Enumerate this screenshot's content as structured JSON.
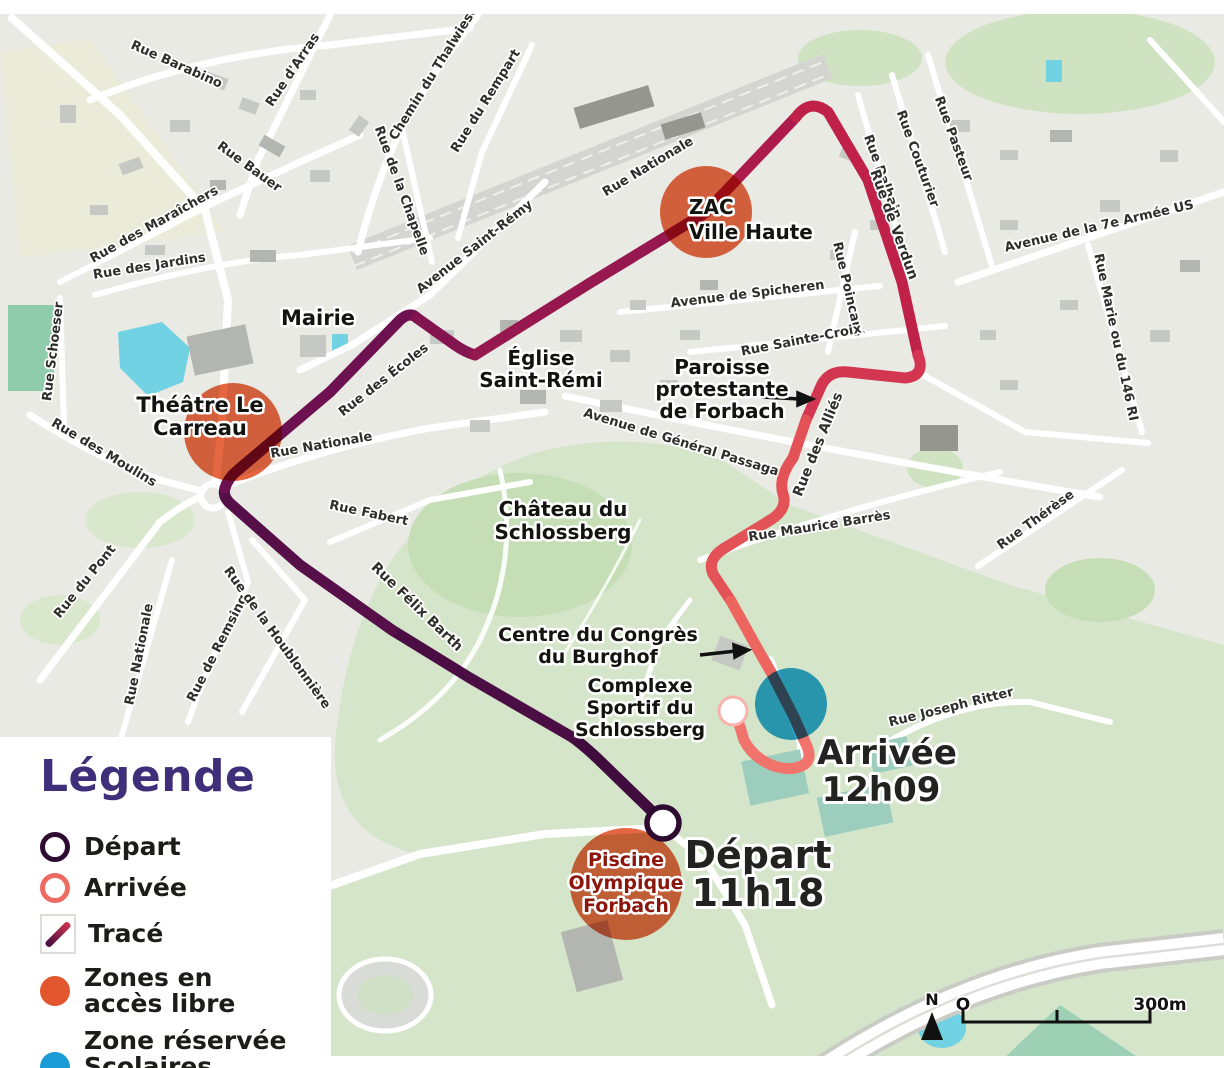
{
  "legend": {
    "title": "Légende",
    "items": [
      {
        "id": "depart",
        "lines": [
          "Départ"
        ]
      },
      {
        "id": "arrivee",
        "lines": [
          "Arrivée"
        ]
      },
      {
        "id": "trace",
        "lines": [
          "Tracé"
        ]
      },
      {
        "id": "zones-acces-libre",
        "lines": [
          "Zones en",
          "accès libre"
        ]
      },
      {
        "id": "zone-reservee",
        "lines": [
          "Zone réservée",
          "Scolaires uniquement"
        ]
      }
    ]
  },
  "colors": {
    "legend_title": "#3f2f7a",
    "depart_ring": "#2e0c31",
    "arrivee_ring": "#ee6a63",
    "zone_acces_libre": "#e2572d",
    "zone_reservee": "#1b9cd6",
    "route_gradient": [
      "#400c3e",
      "#4b0e44",
      "#570f4a",
      "#6d1150",
      "#83144f",
      "#97174f",
      "#ad1b4c",
      "#c02148",
      "#d33650",
      "#e35257",
      "#ec655e",
      "#f0746b"
    ],
    "water": "#70d2e2",
    "park": "#d5e5ca"
  },
  "map": {
    "scale": {
      "north": "N",
      "zero": "O",
      "bar": "300m"
    },
    "markers": {
      "depart": {
        "name": "Départ",
        "time": "11h18"
      },
      "arrivee": {
        "name": "Arrivée",
        "time": "12h09"
      }
    },
    "zones": [
      {
        "name": "Théâtre Le Carreau",
        "type": "acces-libre"
      },
      {
        "name": "ZAC Ville Haute",
        "type": "acces-libre"
      },
      {
        "name": "Piscine Olympique Forbach",
        "type": "acces-libre"
      },
      {
        "name": "Zone scolaires (arrivée)",
        "type": "reservee"
      }
    ],
    "labels": [
      {
        "lines": [
          "Rue Barabino"
        ],
        "x": 175,
        "y": 68,
        "rot": 24
      },
      {
        "lines": [
          "Rue d'Arras"
        ],
        "x": 296,
        "y": 72,
        "rot": -56
      },
      {
        "lines": [
          "Rue Bauer"
        ],
        "x": 247,
        "y": 170,
        "rot": 36
      },
      {
        "lines": [
          "Rue des Maraîchers"
        ],
        "x": 156,
        "y": 228,
        "rot": -29
      },
      {
        "lines": [
          "Rue des Jardins"
        ],
        "x": 150,
        "y": 270,
        "rot": -9
      },
      {
        "lines": [
          "Chemin du Thalwiese"
        ],
        "x": 437,
        "y": 75,
        "rot": -58
      },
      {
        "lines": [
          "Rue du Rempart"
        ],
        "x": 489,
        "y": 103,
        "rot": -58
      },
      {
        "lines": [
          "Rue de la Chapelle"
        ],
        "x": 398,
        "y": 192,
        "rot": 70
      },
      {
        "lines": [
          "Avenue Saint-Rémy"
        ],
        "x": 477,
        "y": 250,
        "rot": -38
      },
      {
        "lines": [
          "Rue Nationale"
        ],
        "x": 650,
        "y": 170,
        "rot": -31
      },
      {
        "lines": [
          "Rue Poincaré"
        ],
        "x": 844,
        "y": 290,
        "rot": 77
      },
      {
        "lines": [
          "Rue Dalhain"
        ],
        "x": 879,
        "y": 178,
        "rot": 70
      },
      {
        "lines": [
          "Rue Couturier"
        ],
        "x": 914,
        "y": 160,
        "rot": 70
      },
      {
        "lines": [
          "Rue Pasteur"
        ],
        "x": 950,
        "y": 140,
        "rot": 70
      },
      {
        "lines": [
          "Rue de Verdun"
        ],
        "x": 890,
        "y": 226,
        "rot": 70,
        "s": 14,
        "w": 800
      },
      {
        "lines": [
          "Avenue de la 7e Armée US"
        ],
        "x": 1100,
        "y": 230,
        "rot": -13
      },
      {
        "lines": [
          "Rue Marie ou du 146 RI"
        ],
        "x": 1112,
        "y": 338,
        "rot": 78
      },
      {
        "lines": [
          "Avenue de Spicheren"
        ],
        "x": 748,
        "y": 298,
        "rot": -7
      },
      {
        "lines": [
          "Rue Sainte-Croix"
        ],
        "x": 802,
        "y": 344,
        "rot": -11
      },
      {
        "lines": [
          "Avenue de Général Passaga"
        ],
        "x": 680,
        "y": 446,
        "rot": 17
      },
      {
        "lines": [
          "Rue des Alliés"
        ],
        "x": 822,
        "y": 446,
        "rot": -68,
        "s": 14,
        "w": 800
      },
      {
        "lines": [
          "Rue Maurice Barrès"
        ],
        "x": 820,
        "y": 530,
        "rot": -9
      },
      {
        "lines": [
          "Rue Thérèse"
        ],
        "x": 1038,
        "y": 523,
        "rot": -36
      },
      {
        "lines": [
          "Rue Schoeser"
        ],
        "x": 57,
        "y": 352,
        "rot": -83
      },
      {
        "lines": [
          "Rue des Moulins"
        ],
        "x": 102,
        "y": 456,
        "rot": 31
      },
      {
        "lines": [
          "Rue du Pont"
        ],
        "x": 88,
        "y": 584,
        "rot": -51
      },
      {
        "lines": [
          "Rue Nationale"
        ],
        "x": 143,
        "y": 655,
        "rot": -79
      },
      {
        "lines": [
          "Rue de Remsing"
        ],
        "x": 221,
        "y": 650,
        "rot": -63
      },
      {
        "lines": [
          "Rue de la Houblonnière"
        ],
        "x": 274,
        "y": 640,
        "rot": 54
      },
      {
        "lines": [
          "Rue Nationale"
        ],
        "x": 322,
        "y": 449,
        "rot": -10
      },
      {
        "lines": [
          "Rue des Écoles"
        ],
        "x": 386,
        "y": 383,
        "rot": -38
      },
      {
        "lines": [
          "Rue Fabert"
        ],
        "x": 368,
        "y": 517,
        "rot": 12
      },
      {
        "lines": [
          "Rue Félix Barth"
        ],
        "x": 414,
        "y": 610,
        "rot": 44,
        "s": 14,
        "w": 700
      },
      {
        "lines": [
          "Rue Joseph Ritter"
        ],
        "x": 952,
        "y": 711,
        "rot": -14
      },
      {
        "lines": [
          "Mairie"
        ],
        "x": 318,
        "y": 325,
        "s": 21
      },
      {
        "lines": [
          "Théâtre Le",
          "Carreau"
        ],
        "x": 200,
        "y": 412,
        "s": 21,
        "lh": 23
      },
      {
        "lines": [
          "Église",
          "Saint-Rémi"
        ],
        "x": 541,
        "y": 365,
        "s": 20,
        "lh": 22
      },
      {
        "lines": [
          "ZAC",
          "Ville Haute"
        ],
        "x": 689,
        "y": 214,
        "s": 20,
        "lh": 25,
        "anchor": "start"
      },
      {
        "lines": [
          "Paroisse",
          "protestante",
          "de Forbach"
        ],
        "x": 722,
        "y": 374,
        "s": 20,
        "lh": 22
      },
      {
        "lines": [
          "Château du",
          "Schlossberg"
        ],
        "x": 563,
        "y": 516,
        "s": 20,
        "lh": 23
      },
      {
        "lines": [
          "Centre du Congrès",
          "du Burghof"
        ],
        "x": 598,
        "y": 641,
        "s": 19,
        "lh": 22
      },
      {
        "lines": [
          "Complexe",
          "Sportif du",
          "Schlossberg"
        ],
        "x": 640,
        "y": 692,
        "s": 19,
        "lh": 22
      },
      {
        "lines": [
          "Piscine",
          "Olympique",
          "Forbach"
        ],
        "x": 626,
        "y": 866,
        "s": 19,
        "lh": 23,
        "fill": "#8c150c"
      },
      {
        "lines": [
          "Départ"
        ],
        "x": 758,
        "y": 868,
        "s": 38,
        "fill": "#222220"
      },
      {
        "lines": [
          "11h18"
        ],
        "x": 758,
        "y": 906,
        "s": 38,
        "fill": "#222220"
      },
      {
        "lines": [
          "Arrivée"
        ],
        "x": 887,
        "y": 764,
        "s": 34,
        "fill": "#222220"
      },
      {
        "lines": [
          "12h09"
        ],
        "x": 881,
        "y": 801,
        "s": 34,
        "fill": "#222220"
      }
    ]
  }
}
